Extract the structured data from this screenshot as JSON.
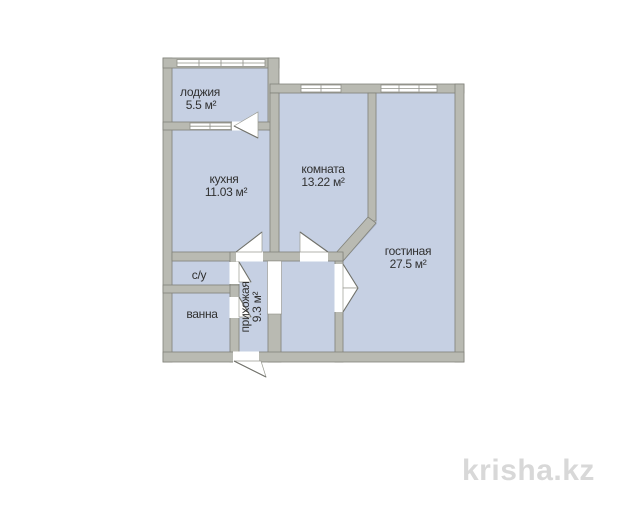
{
  "plan": {
    "rooms": [
      {
        "name": "лоджия",
        "area": "5.5 м²"
      },
      {
        "name": "кухня",
        "area": "11.03 м²"
      },
      {
        "name": "комната",
        "area": "13.22 м²"
      },
      {
        "name": "гостиная",
        "area": "27.5 м²"
      },
      {
        "name": "с/у",
        "area": ""
      },
      {
        "name": "ванна",
        "area": ""
      },
      {
        "name": "прихожая",
        "area": "9.3 м²"
      }
    ]
  },
  "watermark": {
    "text": "krisha.kz"
  },
  "colors": {
    "room_fill": "#c6d0e3",
    "room_edge": "#aab4cb",
    "wall_fill": "#b9bab2",
    "wall_edge": "#82837a",
    "win_line": "#8f9088",
    "leaf_edge": "#9a9b93",
    "leaf_swing": "#70716a",
    "label_text": "#303030",
    "watermark_text": "#d8d8d8"
  }
}
